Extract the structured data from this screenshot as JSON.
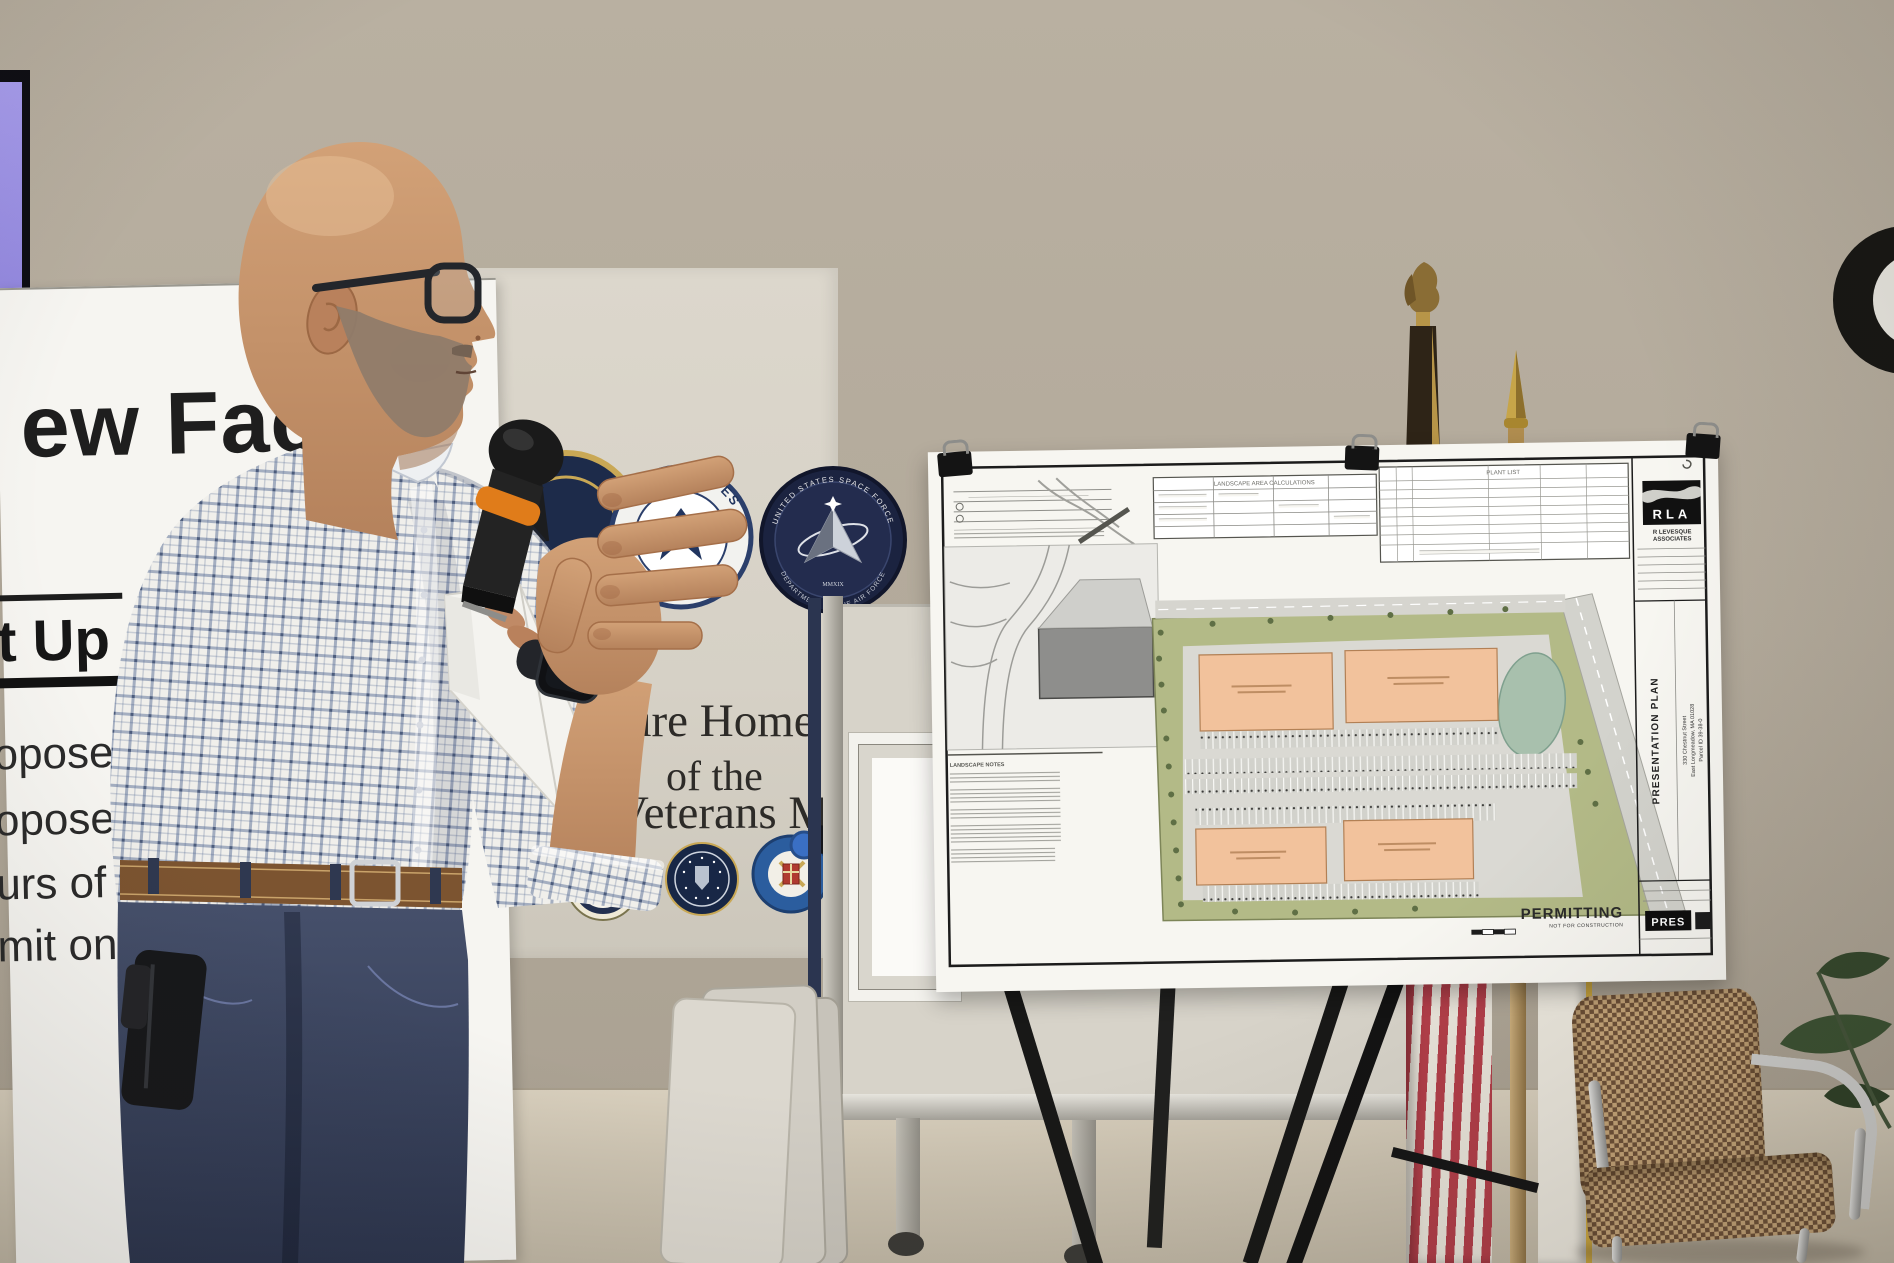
{
  "poster": {
    "title_fragment": "ew Fac",
    "heading_fragment": "t Up",
    "bullet_fragments": [
      "oposed",
      "oposed",
      "urs of C",
      "mit on Nu"
    ]
  },
  "banner": {
    "line1": "ure Home",
    "line2": "of the",
    "line3": "w Veterans Memorial"
  },
  "seals": {
    "air_force_arc": "UNITED STATES",
    "space_force_top": "UNITED STATES SPACE FORCE",
    "space_force_bottom": "DEPARTMENT OF THE AIR FORCE",
    "space_force_year": "MMXIX"
  },
  "watch": {
    "display": "7"
  },
  "board": {
    "logo": "RLA",
    "firm_line1": "R LEVESQUE",
    "firm_line2": "ASSOCIATES",
    "sheet_title": "PRESENTATION PLAN",
    "address_line1": "330 Chestnut Street",
    "address_line2": "East Longmeadow, MA 01028",
    "address_line3": "Parcel ID 39-38-0",
    "stamp": "PERMITTING",
    "stamp_sub": "NOT FOR CONSTRUCTION",
    "badge": "PRES",
    "table_landscape_title": "LANDSCAPE AREA CALCULATIONS",
    "table_plant_title": "PLANT LIST",
    "notes_title": "LANDSCAPE NOTES"
  },
  "colors": {
    "wall": "#b3aa9b",
    "banner": "#d8d3c8",
    "building_salmon": "#f2c29c",
    "grass_olive": "#b3ba87",
    "mic_band": "#e07c1a",
    "jeans": "#3c4660",
    "seal_navy": "#1b2340"
  }
}
